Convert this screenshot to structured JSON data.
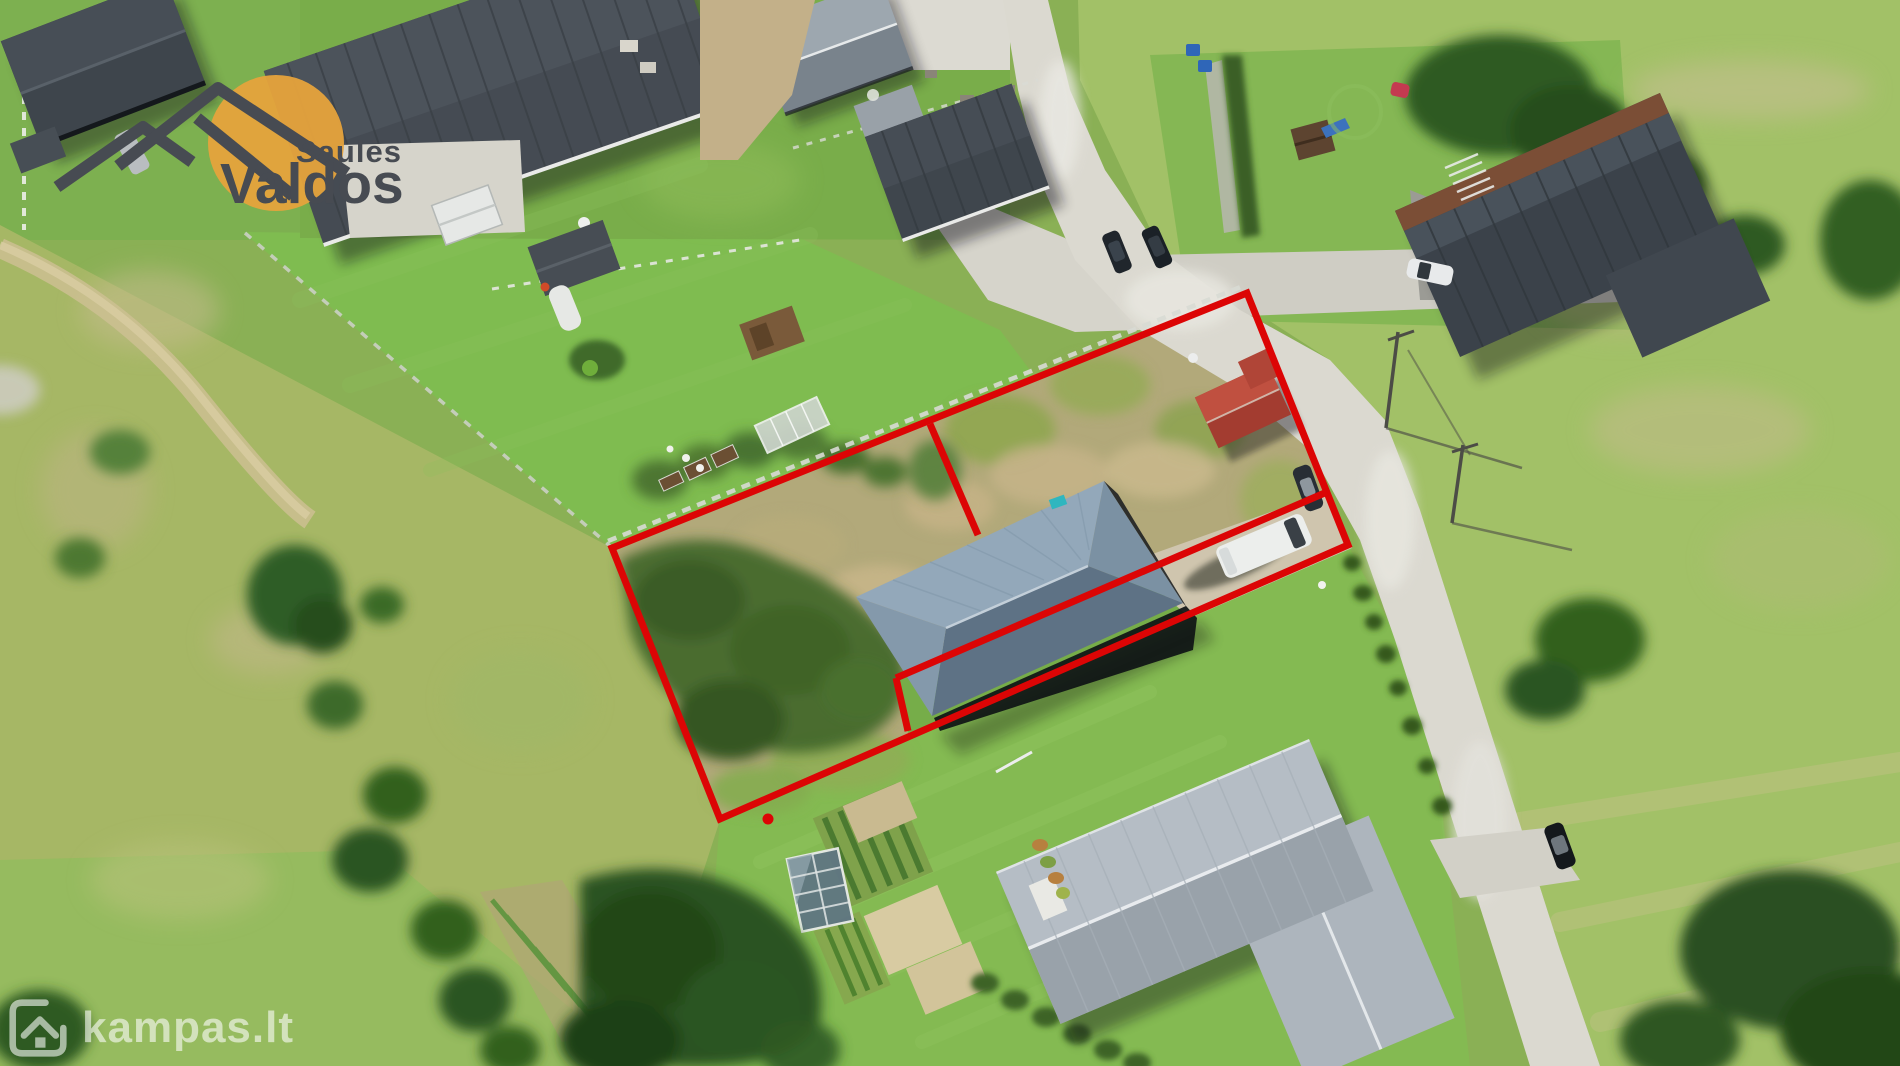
{
  "meta": {
    "type": "aerial-drone-photo-real-estate-listing",
    "width_px": 1900,
    "height_px": 1066
  },
  "branding": {
    "agency_logo": {
      "icon": "sun-mountains-logo-icon",
      "text_top": "Saulės",
      "text_bottom": "Valdos",
      "sun_color": "#e6a33c",
      "text_color": "#474b52"
    },
    "portal_watermark": {
      "icon": "house-logo-icon",
      "text": "kampas.lt",
      "color": "#ffffff",
      "opacity": 0.58
    }
  },
  "overlay": {
    "color": "#dc0505",
    "stroke_width": 7,
    "outer_parcel_px": [
      [
        612,
        548
      ],
      [
        1247,
        293
      ],
      [
        1348,
        545
      ],
      [
        720,
        819
      ]
    ],
    "inner_lines_px": {
      "divider_from_top_edge": [
        [
          930,
          424
        ],
        [
          978,
          535
        ]
      ],
      "driveway_line": [
        [
          1327,
          492
        ],
        [
          896,
          678
        ]
      ],
      "jog_to_bottom_edge": [
        [
          896,
          678
        ],
        [
          908,
          731
        ]
      ]
    },
    "survey_dot_px": [
      768,
      819
    ]
  },
  "scene": {
    "setting": "suburban homestead plots seen from above on a sunny day",
    "marked_parcel": [
      "overgrown grass and bushes in left half",
      "gray hip-roof house in right half",
      "red-roof garden shed",
      "gravel driveway with white van",
      "dry tan grass patches"
    ],
    "surroundings": [
      "dark-roof houses with lawns to the north",
      "light concrete road curving along the east side",
      "large light-gray hip-roof house to the south",
      "vegetable garden, greenhouse and fruit trees to the south-west",
      "meadows, utility poles and tree clusters to the east",
      "dirt track and meadow to the west"
    ],
    "vehicles": [
      "two dark cars by north neighbour",
      "dark car on road",
      "white van on parcel driveway",
      "white car at north-east house",
      "dark car at south-east driveway",
      "white caravan by fence"
    ]
  }
}
